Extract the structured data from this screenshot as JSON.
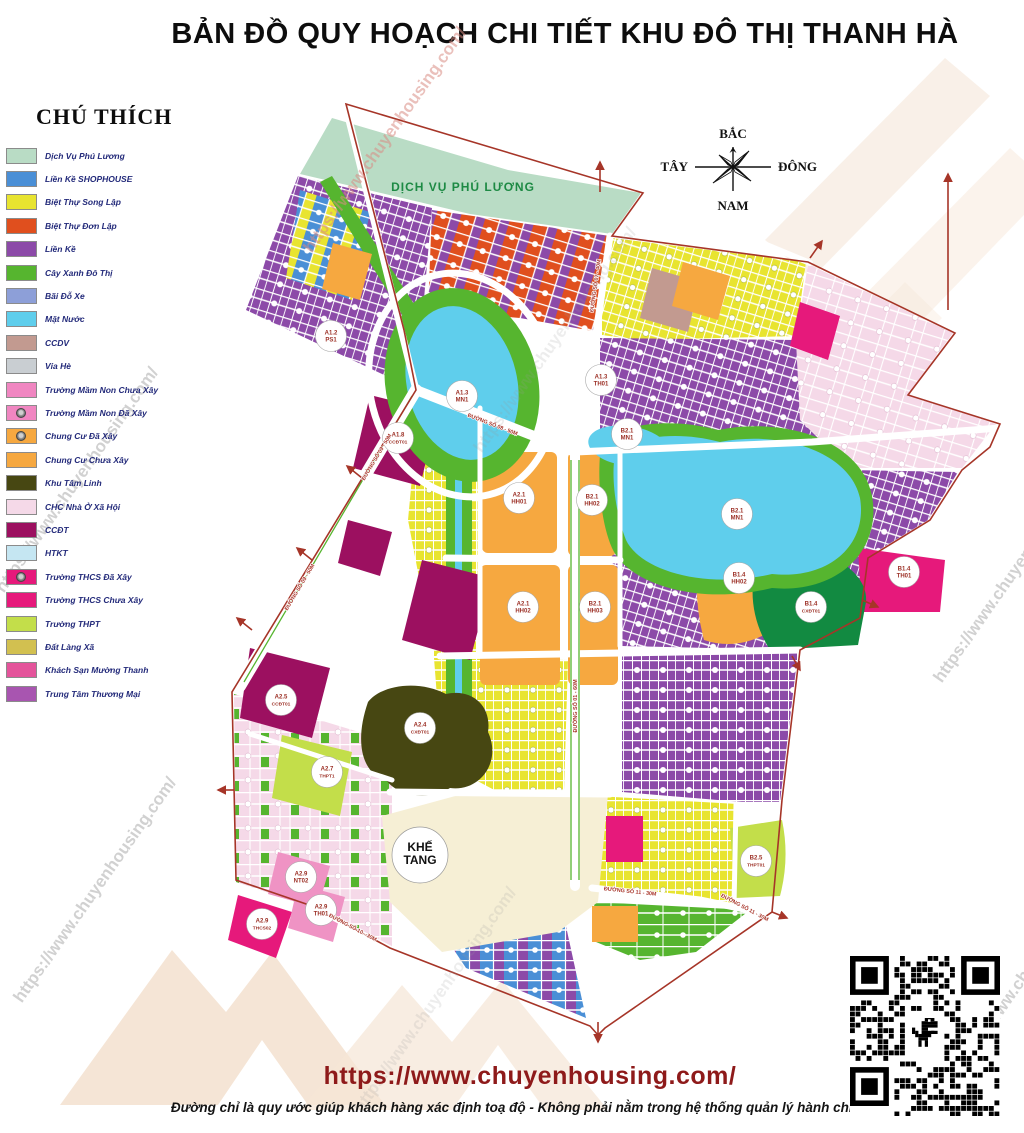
{
  "title": "BẢN ĐỒ QUY HOẠCH CHI TIẾT  KHU ĐÔ THỊ THANH HÀ",
  "legend": {
    "heading": "CHÚ THÍCH",
    "items": [
      {
        "label": "Dịch Vụ Phú Lương",
        "color": "#b9dcc5",
        "built_icon": false
      },
      {
        "label": "Liền Kề SHOPHOUSE",
        "color": "#4a8fd6",
        "built_icon": false
      },
      {
        "label": "Biệt Thự Song Lập",
        "color": "#e8e430",
        "built_icon": false
      },
      {
        "label": "Biệt Thự Đơn Lập",
        "color": "#e04f1e",
        "built_icon": false
      },
      {
        "label": "Liền Kề",
        "color": "#8c4aa8",
        "built_icon": false
      },
      {
        "label": "Cây Xanh Đô Thị",
        "color": "#56b52f",
        "built_icon": false
      },
      {
        "label": "Bãi Đỗ Xe",
        "color": "#8d9fd8",
        "built_icon": false
      },
      {
        "label": "Mặt Nước",
        "color": "#5fceec",
        "built_icon": false
      },
      {
        "label": "CCDV",
        "color": "#c29a90",
        "built_icon": false
      },
      {
        "label": "Vỉa Hè",
        "color": "#c9ced2",
        "built_icon": false
      },
      {
        "label": "Trường Mầm Non Chưa Xây",
        "color": "#f086c1",
        "built_icon": false
      },
      {
        "label": "Trường Mầm Non Đã Xây",
        "color": "#f086c1",
        "built_icon": true
      },
      {
        "label": "Chung Cư Đã Xây",
        "color": "#f6a840",
        "built_icon": true
      },
      {
        "label": "Chung Cư Chưa Xây",
        "color": "#f6a840",
        "built_icon": false
      },
      {
        "label": "Khu Tâm Linh",
        "color": "#474712",
        "built_icon": false
      },
      {
        "label": "CHC Nhà Ở Xã Hội",
        "color": "#f5d9e8",
        "built_icon": false
      },
      {
        "label": "CCĐT",
        "color": "#9c1060",
        "built_icon": false
      },
      {
        "label": "HTKT",
        "color": "#c5e6f2",
        "built_icon": false
      },
      {
        "label": "Trường THCS Đã Xây",
        "color": "#e6197b",
        "built_icon": true
      },
      {
        "label": "Trường THCS Chưa Xây",
        "color": "#e6197b",
        "built_icon": false
      },
      {
        "label": "Trường THPT",
        "color": "#c3de4a",
        "built_icon": false
      },
      {
        "label": "Đất Làng Xã",
        "color": "#d2c050",
        "built_icon": false
      },
      {
        "label": "Khách Sạn Mường Thanh",
        "color": "#e4549b",
        "built_icon": false
      },
      {
        "label": "Trung Tâm Thương Mại",
        "color": "#a855b0",
        "built_icon": false
      }
    ]
  },
  "compass": {
    "north": "BẮC",
    "south": "NAM",
    "west": "TÂY",
    "east": "ĐÔNG"
  },
  "map": {
    "area_labels": [
      {
        "text": "DỊCH VỤ PHÚ LƯƠNG"
      },
      {
        "text": "KHẾ TANG"
      }
    ],
    "zone_labels": [
      {
        "code": "A1.3",
        "name": "MN1",
        "x": 462,
        "y": 396
      },
      {
        "code": "B2.1",
        "name": "MN1",
        "x": 627,
        "y": 434
      },
      {
        "code": "B2.1",
        "name": "MN1",
        "x": 737,
        "y": 514
      },
      {
        "code": "A2.1",
        "name": "HH01",
        "x": 519,
        "y": 498
      },
      {
        "code": "B2.1",
        "name": "HH02",
        "x": 592,
        "y": 500
      },
      {
        "code": "A2.1",
        "name": "HH02",
        "x": 523,
        "y": 607
      },
      {
        "code": "B2.1",
        "name": "HH03",
        "x": 595,
        "y": 607
      },
      {
        "code": "B1.4",
        "name": "HH02",
        "x": 739,
        "y": 578
      },
      {
        "code": "B1.4",
        "name": "TH01",
        "x": 904,
        "y": 572
      },
      {
        "code": "B1.4",
        "name": "CXĐT01",
        "x": 811,
        "y": 607
      },
      {
        "code": "A2.4",
        "name": "CXĐT01",
        "x": 420,
        "y": 728
      },
      {
        "code": "A2.7",
        "name": "THPT1",
        "x": 327,
        "y": 772
      },
      {
        "code": "B2.5",
        "name": "THPT01",
        "x": 756,
        "y": 861
      },
      {
        "code": "A2.9",
        "name": "NT02",
        "x": 301,
        "y": 877
      },
      {
        "code": "A2.9",
        "name": "TH01",
        "x": 321,
        "y": 910
      },
      {
        "code": "A2.9",
        "name": "THCS02",
        "x": 262,
        "y": 924
      },
      {
        "code": "A1.2",
        "name": "PS1",
        "x": 331,
        "y": 336
      },
      {
        "code": "A1.8",
        "name": "CCĐT01",
        "x": 398,
        "y": 438
      },
      {
        "code": "A2.5",
        "name": "CCĐT01",
        "x": 281,
        "y": 700
      },
      {
        "code": "A1.3",
        "name": "TH01",
        "x": 601,
        "y": 380
      }
    ],
    "road_labels": [
      {
        "text": "ĐƯỜNG SỐ 09 - 50M",
        "x": 378,
        "y": 458,
        "rot": -59
      },
      {
        "text": "ĐƯỜNG SỐ 09 - 50M",
        "x": 301,
        "y": 588,
        "rot": -59
      },
      {
        "text": "ĐƯỜNG SỐ 08 - 50M",
        "x": 492,
        "y": 426,
        "rot": 21
      },
      {
        "text": "ĐƯỜNG SỐ 01 - 60M",
        "x": 577,
        "y": 706,
        "rot": -90
      },
      {
        "text": "ĐƯỜNG SỐ 07 - 40M",
        "x": 597,
        "y": 286,
        "rot": -82
      },
      {
        "text": "ĐƯỜNG SỐ 11 - 30M",
        "x": 630,
        "y": 893,
        "rot": 6
      },
      {
        "text": "ĐƯỜNG SỐ 11 - 30M",
        "x": 744,
        "y": 909,
        "rot": 28
      },
      {
        "text": "ĐƯỜNG SỐ 10 - 30M",
        "x": 352,
        "y": 929,
        "rot": 28
      }
    ]
  },
  "footer": {
    "url": "https://www.chuyenhousing.com/",
    "disclaimer": "Đường chỉ là quy ước giúp khách hàng xác định toạ độ - Không phải nằm trong hệ thống quản lý hành chính"
  },
  "watermark": {
    "text": "https://www.chuyenhousing.com/"
  }
}
